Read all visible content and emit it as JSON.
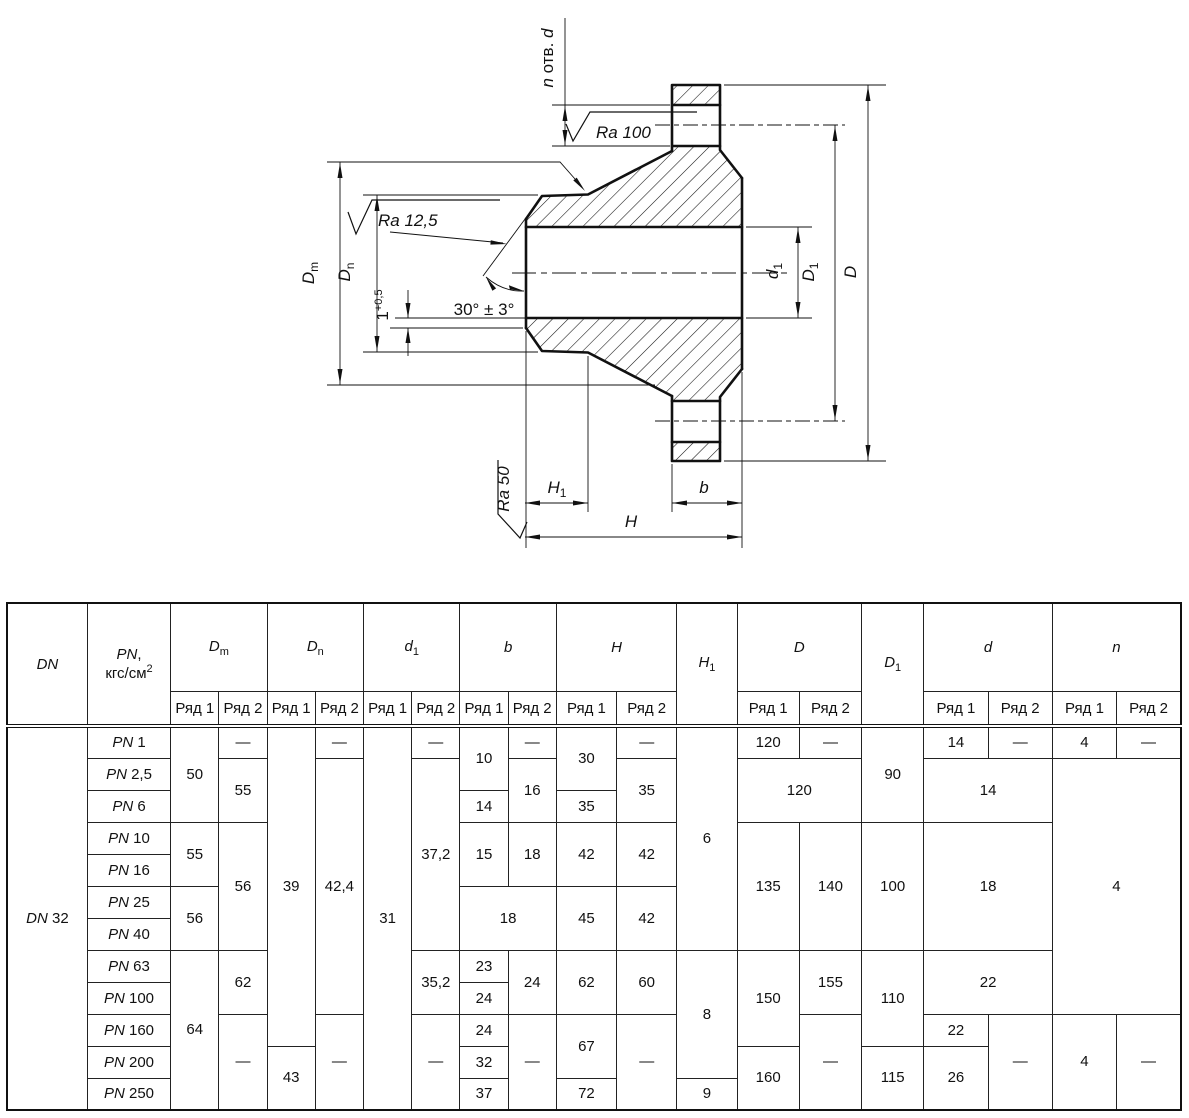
{
  "symbols": {
    "D": "D",
    "d": "d",
    "m": "m",
    "n": "n",
    "one": "1",
    "b": "b",
    "H": "H",
    "n_col": "n"
  },
  "drawing": {
    "n_prefix": "n",
    "n_mid": " отв. ",
    "n_suffix": "d",
    "ra_top": "Ra 100",
    "ra_cone": "Ra 12,5",
    "ra_face": "Ra 50",
    "angle": "30° ± 3°",
    "land": "1",
    "land_tol": "+0,5"
  },
  "table": {
    "header": {
      "dn": "DN",
      "pn_sym": "PN",
      "pn_comma": ",",
      "pn_unit": "кгс/см",
      "pn_sup": "2",
      "series1": "Ряд 1",
      "series2": "Ряд 2"
    },
    "body": [
      [
        {
          "i": "DN",
          "t": " 32",
          "rs": 12,
          "name": "cell-dn"
        },
        {
          "i": "PN",
          "t": " 1",
          "name": "row-label"
        },
        {
          "t": "50",
          "rs": 3
        },
        {
          "t": "—"
        },
        {
          "t": "39",
          "rs": 10
        },
        {
          "t": "—"
        },
        {
          "t": "31",
          "rs": 12
        },
        {
          "t": "—"
        },
        {
          "t": "10",
          "rs": 2
        },
        {
          "t": "—"
        },
        {
          "t": "30",
          "rs": 2
        },
        {
          "t": "—"
        },
        {
          "t": "6",
          "rs": 7
        },
        {
          "t": "120"
        },
        {
          "t": "—"
        },
        {
          "t": "90",
          "rs": 3
        },
        {
          "t": "14"
        },
        {
          "t": "—"
        },
        {
          "t": "4"
        },
        {
          "t": "—"
        }
      ],
      [
        {
          "i": "PN",
          "t": " 2,5",
          "name": "row-label"
        },
        {
          "t": "55",
          "rs": 2
        },
        {
          "t": "42,4",
          "rs": 8
        },
        {
          "t": "37,2",
          "rs": 6
        },
        {
          "t": "16",
          "rs": 2
        },
        {
          "t": "35",
          "rs": 2
        },
        {
          "t": "120",
          "cs": 2,
          "rs": 2
        },
        {
          "t": "14",
          "cs": 2,
          "rs": 2
        },
        {
          "t": "4",
          "cs": 2,
          "rs": 8
        }
      ],
      [
        {
          "i": "PN",
          "t": " 6",
          "name": "row-label"
        },
        {
          "t": "14"
        },
        {
          "t": "35"
        }
      ],
      [
        {
          "i": "PN",
          "t": " 10",
          "name": "row-label"
        },
        {
          "t": "55",
          "rs": 2
        },
        {
          "t": "56",
          "rs": 4
        },
        {
          "t": "15",
          "rs": 2
        },
        {
          "t": "18",
          "rs": 2
        },
        {
          "t": "42",
          "rs": 2
        },
        {
          "t": "42",
          "rs": 2
        },
        {
          "t": "135",
          "rs": 4
        },
        {
          "t": "140",
          "rs": 4
        },
        {
          "t": "100",
          "rs": 4
        },
        {
          "t": "18",
          "cs": 2,
          "rs": 4
        }
      ],
      [
        {
          "i": "PN",
          "t": " 16",
          "name": "row-label"
        }
      ],
      [
        {
          "i": "PN",
          "t": " 25",
          "name": "row-label"
        },
        {
          "t": "56",
          "rs": 2
        },
        {
          "t": "18",
          "cs": 2,
          "rs": 2
        },
        {
          "t": "45",
          "rs": 2
        },
        {
          "t": "42",
          "rs": 2
        }
      ],
      [
        {
          "i": "PN",
          "t": " 40",
          "name": "row-label"
        }
      ],
      [
        {
          "i": "PN",
          "t": " 63",
          "name": "row-label"
        },
        {
          "t": "64",
          "rs": 5
        },
        {
          "t": "62",
          "rs": 2
        },
        {
          "t": "35,2",
          "rs": 2
        },
        {
          "t": "23"
        },
        {
          "t": "24",
          "rs": 2
        },
        {
          "t": "62",
          "rs": 2
        },
        {
          "t": "60",
          "rs": 2
        },
        {
          "t": "8",
          "rs": 4
        },
        {
          "t": "150",
          "rs": 3
        },
        {
          "t": "155",
          "rs": 2
        },
        {
          "t": "110",
          "rs": 3
        },
        {
          "t": "22",
          "cs": 2,
          "rs": 2
        }
      ],
      [
        {
          "i": "PN",
          "t": " 100",
          "name": "row-label"
        },
        {
          "t": "24"
        }
      ],
      [
        {
          "i": "PN",
          "t": " 160",
          "name": "row-label"
        },
        {
          "t": "—",
          "rs": 3
        },
        {
          "t": "—",
          "rs": 3
        },
        {
          "t": "—",
          "rs": 3
        },
        {
          "t": "24"
        },
        {
          "t": "—",
          "rs": 3
        },
        {
          "t": "67",
          "rs": 2
        },
        {
          "t": "—",
          "rs": 3
        },
        {
          "t": "—",
          "rs": 3
        },
        {
          "t": "22"
        },
        {
          "t": "—",
          "rs": 3
        },
        {
          "t": "4",
          "rs": 3
        },
        {
          "t": "—",
          "rs": 3
        }
      ],
      [
        {
          "i": "PN",
          "t": " 200",
          "name": "row-label"
        },
        {
          "t": "43",
          "rs": 2
        },
        {
          "t": "32"
        },
        {
          "t": "160",
          "rs": 2
        },
        {
          "t": "115",
          "rs": 2
        },
        {
          "t": "26",
          "rs": 2
        }
      ],
      [
        {
          "i": "PN",
          "t": " 250",
          "name": "row-label"
        },
        {
          "t": "37"
        },
        {
          "t": "72"
        },
        {
          "t": "9"
        }
      ]
    ]
  }
}
